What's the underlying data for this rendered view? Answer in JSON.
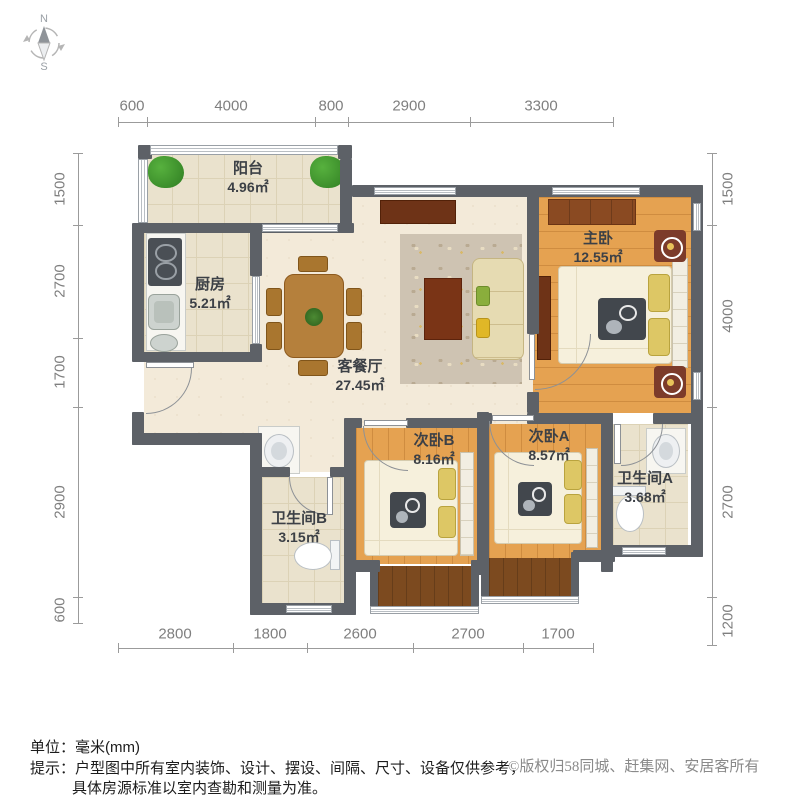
{
  "compass": {
    "north": "N",
    "south": "S"
  },
  "dimensions": {
    "unit": "mm",
    "top": [
      "600",
      "4000",
      "800",
      "2900",
      "3300"
    ],
    "bottom": [
      "2800",
      "1800",
      "2600",
      "2700",
      "1700"
    ],
    "left": [
      "1500",
      "2700",
      "1700",
      "2900",
      "600"
    ],
    "right": [
      "1500",
      "4000",
      "2700",
      "1200"
    ]
  },
  "rooms": [
    {
      "name": "阳台",
      "area": "4.96㎡"
    },
    {
      "name": "厨房",
      "area": "5.21㎡"
    },
    {
      "name": "客餐厅",
      "area": "27.45㎡"
    },
    {
      "name": "主卧",
      "area": "12.55㎡"
    },
    {
      "name": "次卧B",
      "area": "8.16㎡"
    },
    {
      "name": "次卧A",
      "area": "8.57㎡"
    },
    {
      "name": "卫生间A",
      "area": "3.68㎡"
    },
    {
      "name": "卫生间B",
      "area": "3.15㎡"
    }
  ],
  "footer": {
    "unit_label": "单位：毫米(mm)",
    "tip_line1": "提示：户型图中所有室内装饰、设计、摆设、间隔、尺寸、设备仅供参考，",
    "tip_line2": "具体房源标准以室内查勘和测量为准。",
    "copyright": "©版权归58同城、赶集网、安居客所有"
  },
  "colors": {
    "wall": "#5d6167",
    "wood_floor": "#e5a251",
    "tile_floor": "#eae2cd",
    "living_floor": "#f3ead9",
    "bay_floor": "#7c4a1f",
    "dim_text": "#7f7f7f"
  }
}
